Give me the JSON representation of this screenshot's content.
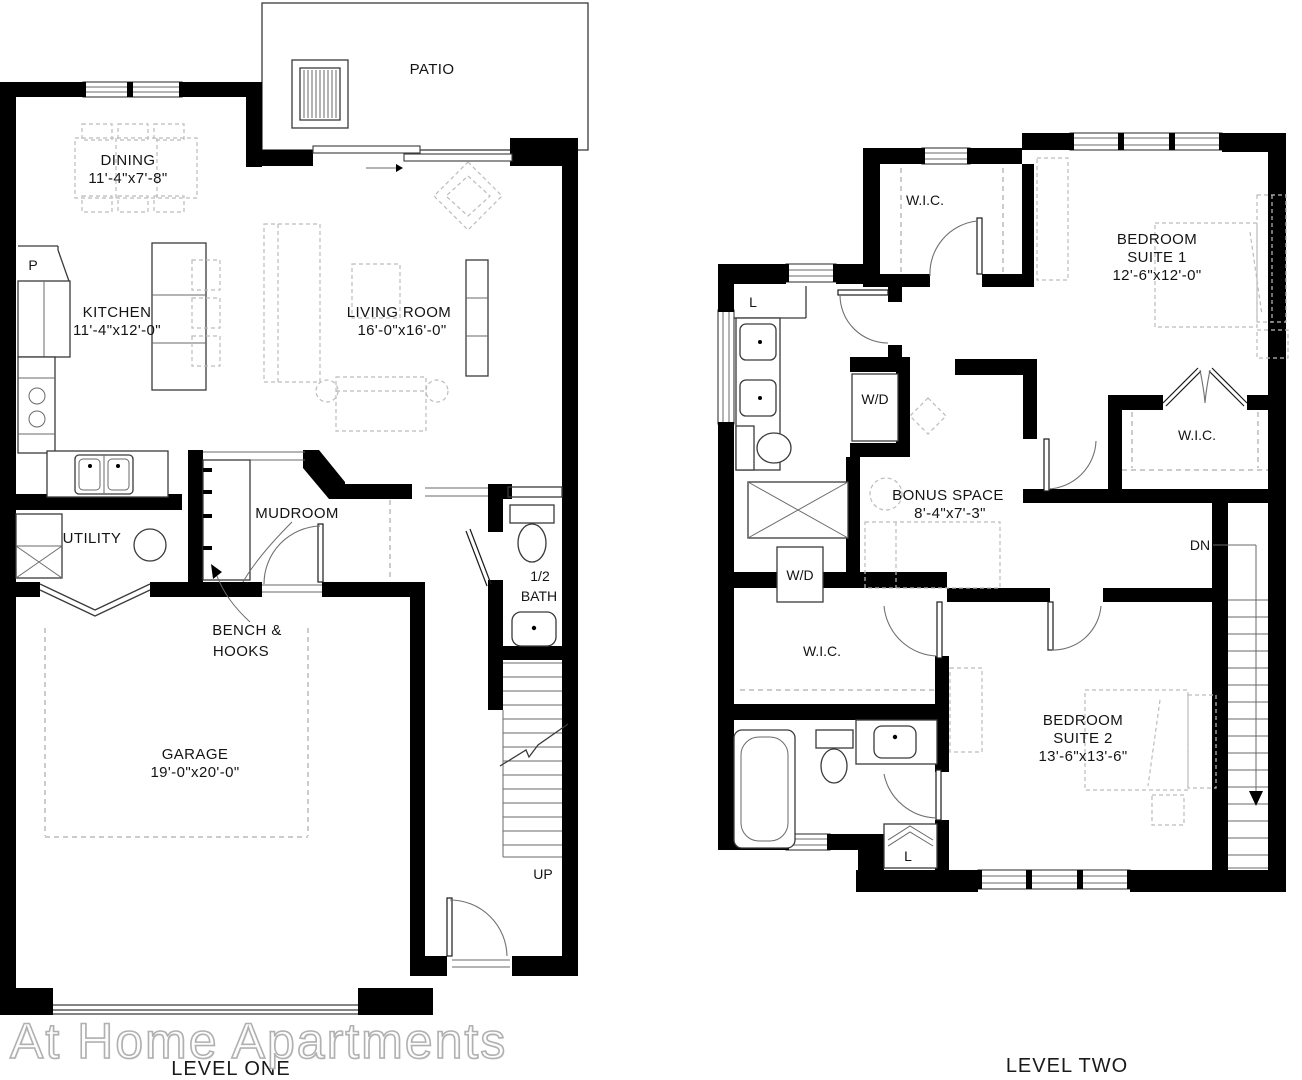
{
  "watermark": "At Home Apartments",
  "colors": {
    "wall": "#000000",
    "thin_line": "#3a3a3a",
    "furniture_dash": "#bcbcbc",
    "text": "#141414",
    "watermark_stroke": "#b0b0b0"
  },
  "level_one": {
    "caption": "LEVEL ONE",
    "patio": {
      "label": "PATIO"
    },
    "dining": {
      "label": "DINING",
      "dims": "11'-4\"x7'-8\""
    },
    "kitchen": {
      "label": "KITCHEN",
      "dims": "11'-4\"x12'-0\"",
      "pantry": "P"
    },
    "living_room": {
      "label": "LIVING ROOM",
      "dims": "16'-0\"x16'-0\""
    },
    "utility": {
      "label": "UTILITY"
    },
    "mudroom": {
      "label": "MUDROOM",
      "callout_line1": "BENCH &",
      "callout_line2": "HOOKS"
    },
    "half_bath": {
      "label_line1": "1/2",
      "label_line2": "BATH"
    },
    "garage": {
      "label": "GARAGE",
      "dims": "19'-0\"x20'-0\""
    },
    "stairs": {
      "label": "UP"
    }
  },
  "level_two": {
    "caption": "LEVEL TWO",
    "wic_hall": {
      "label": "W.I.C."
    },
    "bedroom_suite1": {
      "label_line1": "BEDROOM",
      "label_line2": "SUITE 1",
      "dims": "12'-6\"x12'-0\""
    },
    "wic_suite1": {
      "label": "W.I.C."
    },
    "linen_upper": {
      "label": "L"
    },
    "washer_dryer_1": {
      "label": "W/D"
    },
    "bonus_space": {
      "label": "BONUS SPACE",
      "dims": "8'-4\"x7'-3\""
    },
    "stairs": {
      "label": "DN"
    },
    "washer_dryer_2": {
      "label": "W/D"
    },
    "wic_suite2": {
      "label": "W.I.C."
    },
    "bedroom_suite2": {
      "label_line1": "BEDROOM",
      "label_line2": "SUITE 2",
      "dims": "13'-6\"x13'-6\""
    },
    "linen_lower": {
      "label": "L"
    }
  }
}
